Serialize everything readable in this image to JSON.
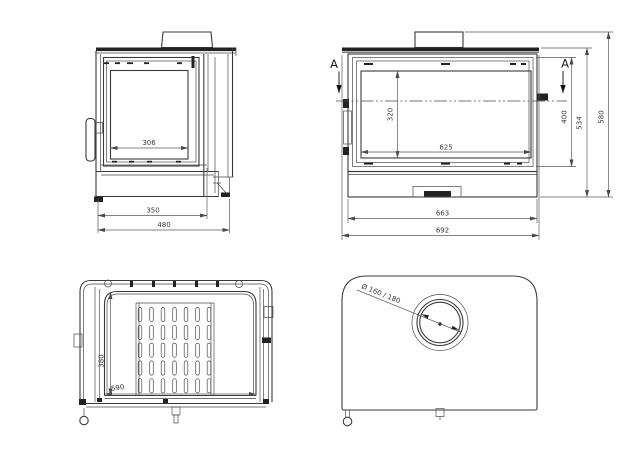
{
  "views": {
    "side": {
      "glass_width": "306",
      "body_depth": "350",
      "overall_depth": "480"
    },
    "front": {
      "section_marker_left": "A",
      "section_marker_right": "A",
      "glass_height": "320",
      "glass_width": "625",
      "body_width": "663",
      "overall_width": "692",
      "door_height": "400",
      "body_height": "534",
      "overall_height": "580"
    },
    "section": {
      "firebox_depth": "380",
      "firebox_width": "590"
    },
    "top": {
      "flue_diameter": "Ø 160 / 180"
    }
  },
  "colors": {
    "line": "#3a3a3a",
    "dim_line": "#5a5a5a",
    "background": "#ffffff"
  }
}
